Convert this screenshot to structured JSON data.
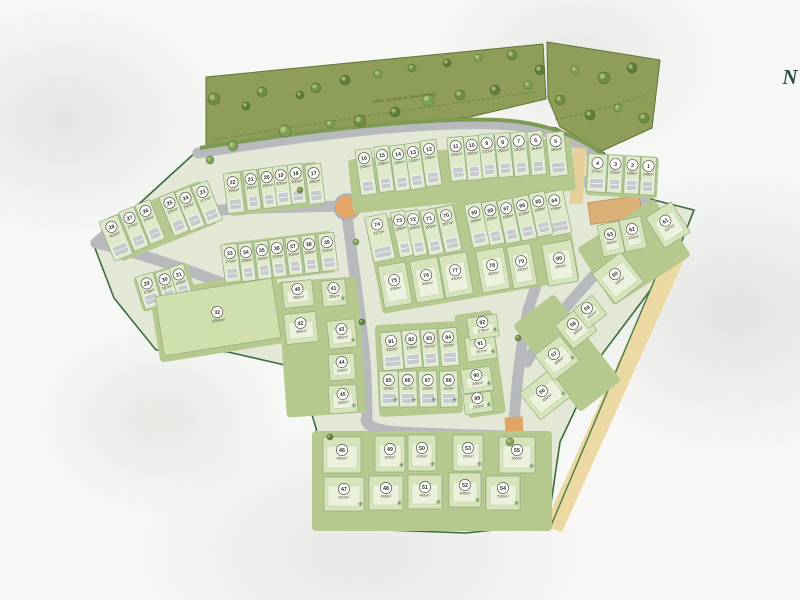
{
  "map": {
    "north_label": "N",
    "open_space_label": "AREA OF PUBLIC OPEN SPACE",
    "roundabout_color": "#e2a667",
    "road_color": "#b7babc",
    "boundary_color": "#3c6b3c",
    "open_space_color": "#8e9e58",
    "plots": [
      {
        "num": "1",
        "area": "248m²",
        "x": 648,
        "y": 176,
        "w": 15,
        "h": 38,
        "rot": 3,
        "kind": "row",
        "tree": 0
      },
      {
        "num": "2",
        "area": "188m²",
        "x": 632,
        "y": 175,
        "w": 15,
        "h": 38,
        "rot": 3,
        "kind": "row",
        "tree": 0
      },
      {
        "num": "3",
        "area": "205m²",
        "x": 615,
        "y": 174,
        "w": 15,
        "h": 38,
        "rot": 3,
        "kind": "row",
        "tree": 0
      },
      {
        "num": "4",
        "area": "370m²",
        "x": 597,
        "y": 173,
        "w": 19,
        "h": 38,
        "rot": 3,
        "kind": "row",
        "tree": 0
      },
      {
        "num": "5",
        "area": "265m²",
        "x": 557,
        "y": 154,
        "w": 18,
        "h": 44,
        "rot": -6,
        "kind": "row",
        "tree": 0
      },
      {
        "num": "6",
        "area": "184m²",
        "x": 537,
        "y": 153,
        "w": 15,
        "h": 44,
        "rot": -6,
        "kind": "row",
        "tree": 0
      },
      {
        "num": "7",
        "area": "190m²",
        "x": 520,
        "y": 154,
        "w": 15,
        "h": 44,
        "rot": -6,
        "kind": "row",
        "tree": 0
      },
      {
        "num": "8",
        "area": "255m²",
        "x": 504,
        "y": 155,
        "w": 15,
        "h": 44,
        "rot": -6,
        "kind": "row",
        "tree": 0
      },
      {
        "num": "9",
        "area": "210m²",
        "x": 488,
        "y": 156,
        "w": 15,
        "h": 44,
        "rot": -6,
        "kind": "row",
        "tree": 0
      },
      {
        "num": "10",
        "area": "200m²",
        "x": 473,
        "y": 158,
        "w": 15,
        "h": 44,
        "rot": -6,
        "kind": "row",
        "tree": 0
      },
      {
        "num": "11",
        "area": "245m²",
        "x": 457,
        "y": 159,
        "w": 16,
        "h": 44,
        "rot": -6,
        "kind": "row",
        "tree": 0
      },
      {
        "num": "12",
        "area": "245m²",
        "x": 431,
        "y": 163,
        "w": 16,
        "h": 46,
        "rot": -8,
        "kind": "row",
        "tree": 0
      },
      {
        "num": "13",
        "area": "210m²",
        "x": 415,
        "y": 166,
        "w": 15,
        "h": 46,
        "rot": -8,
        "kind": "row",
        "tree": 0
      },
      {
        "num": "14",
        "area": "200m²",
        "x": 400,
        "y": 168,
        "w": 15,
        "h": 46,
        "rot": -8,
        "kind": "row",
        "tree": 0
      },
      {
        "num": "15",
        "area": "200m²",
        "x": 384,
        "y": 169,
        "w": 15,
        "h": 46,
        "rot": -8,
        "kind": "row",
        "tree": 0
      },
      {
        "num": "16",
        "area": "200m²",
        "x": 366,
        "y": 172,
        "w": 16,
        "h": 46,
        "rot": -8,
        "kind": "row",
        "tree": 0
      },
      {
        "num": "17",
        "area": "185m²",
        "x": 315,
        "y": 184,
        "w": 16,
        "h": 40,
        "rot": -7,
        "kind": "row",
        "tree": 0
      },
      {
        "num": "18",
        "area": "200m²",
        "x": 297,
        "y": 184,
        "w": 15,
        "h": 40,
        "rot": -7,
        "kind": "row",
        "tree": 0
      },
      {
        "num": "19",
        "area": "200m²",
        "x": 282,
        "y": 186,
        "w": 15,
        "h": 40,
        "rot": -7,
        "kind": "row",
        "tree": 0
      },
      {
        "num": "20",
        "area": "185m²",
        "x": 268,
        "y": 188,
        "w": 14,
        "h": 40,
        "rot": -7,
        "kind": "row",
        "tree": 0
      },
      {
        "num": "21",
        "area": "182m²",
        "x": 252,
        "y": 190,
        "w": 14,
        "h": 40,
        "rot": -7,
        "kind": "row",
        "tree": 0
      },
      {
        "num": "22",
        "area": "226m²",
        "x": 234,
        "y": 193,
        "w": 17,
        "h": 40,
        "rot": -7,
        "kind": "row",
        "tree": 0
      },
      {
        "num": "23",
        "area": "277m²",
        "x": 207,
        "y": 203,
        "w": 17,
        "h": 42,
        "rot": -22,
        "kind": "row",
        "tree": 0
      },
      {
        "num": "24",
        "area": "260m²",
        "x": 190,
        "y": 209,
        "w": 16,
        "h": 42,
        "rot": -22,
        "kind": "row",
        "tree": 0
      },
      {
        "num": "25",
        "area": "235m²",
        "x": 174,
        "y": 214,
        "w": 16,
        "h": 42,
        "rot": -22,
        "kind": "row",
        "tree": 0
      },
      {
        "num": "26",
        "area": "245m²",
        "x": 150,
        "y": 222,
        "w": 16,
        "h": 42,
        "rot": -22,
        "kind": "row",
        "tree": 0
      },
      {
        "num": "27",
        "area": "270m²",
        "x": 134,
        "y": 229,
        "w": 16,
        "h": 42,
        "rot": -22,
        "kind": "row",
        "tree": 0
      },
      {
        "num": "28",
        "area": "403m²",
        "x": 116,
        "y": 238,
        "w": 20,
        "h": 42,
        "rot": -22,
        "kind": "row",
        "tree": 0
      },
      {
        "num": "29",
        "area": "278m²",
        "x": 149,
        "y": 291,
        "w": 18,
        "h": 34,
        "rot": -17,
        "kind": "row",
        "tree": 0
      },
      {
        "num": "30",
        "area": "187m²",
        "x": 167,
        "y": 287,
        "w": 15,
        "h": 34,
        "rot": -17,
        "kind": "row",
        "tree": 0
      },
      {
        "num": "31",
        "area": "205m²",
        "x": 181,
        "y": 282,
        "w": 15,
        "h": 34,
        "rot": -17,
        "kind": "row",
        "tree": 0
      },
      {
        "num": "32",
        "area": "2056m²",
        "x": 218,
        "y": 317,
        "w": 118,
        "h": 60,
        "rot": -9,
        "kind": "field",
        "tree": 0
      },
      {
        "num": "33",
        "area": "275m²",
        "x": 231,
        "y": 263,
        "w": 16,
        "h": 38,
        "rot": -7,
        "kind": "row",
        "tree": 0
      },
      {
        "num": "34",
        "area": "208m²",
        "x": 247,
        "y": 262,
        "w": 14,
        "h": 38,
        "rot": -7,
        "kind": "row",
        "tree": 0
      },
      {
        "num": "35",
        "area": "183m²",
        "x": 263,
        "y": 260,
        "w": 14,
        "h": 38,
        "rot": -7,
        "kind": "row",
        "tree": 0
      },
      {
        "num": "36",
        "area": "192m²",
        "x": 278,
        "y": 258,
        "w": 14,
        "h": 38,
        "rot": -7,
        "kind": "row",
        "tree": 0
      },
      {
        "num": "37",
        "area": "200m²",
        "x": 294,
        "y": 256,
        "w": 14,
        "h": 38,
        "rot": -7,
        "kind": "row",
        "tree": 0
      },
      {
        "num": "38",
        "area": "208m²",
        "x": 310,
        "y": 254,
        "w": 14,
        "h": 38,
        "rot": -7,
        "kind": "row",
        "tree": 0
      },
      {
        "num": "39",
        "area": "222m²",
        "x": 328,
        "y": 252,
        "w": 16,
        "h": 38,
        "rot": -7,
        "kind": "row",
        "tree": 0
      },
      {
        "num": "40",
        "area": "350m²",
        "x": 298,
        "y": 294,
        "w": 30,
        "h": 26,
        "rot": -6,
        "kind": "sq",
        "tree": 0
      },
      {
        "num": "41",
        "area": "205m²",
        "x": 334,
        "y": 293,
        "w": 24,
        "h": 26,
        "rot": -6,
        "kind": "sq",
        "tree": 1
      },
      {
        "num": "42",
        "area": "465m²",
        "x": 301,
        "y": 328,
        "w": 32,
        "h": 30,
        "rot": -6,
        "kind": "sq",
        "tree": 0
      },
      {
        "num": "43",
        "area": "352m²",
        "x": 342,
        "y": 334,
        "w": 28,
        "h": 28,
        "rot": -6,
        "kind": "sq",
        "tree": 1
      },
      {
        "num": "44",
        "area": "243m²",
        "x": 342,
        "y": 367,
        "w": 26,
        "h": 26,
        "rot": -4,
        "kind": "sq",
        "tree": 0
      },
      {
        "num": "45",
        "area": "325m²",
        "x": 343,
        "y": 399,
        "w": 28,
        "h": 28,
        "rot": -4,
        "kind": "sq",
        "tree": 1
      },
      {
        "num": "46",
        "area": "480m²",
        "x": 342,
        "y": 455,
        "w": 38,
        "h": 36,
        "rot": 0,
        "kind": "sq",
        "tree": 0
      },
      {
        "num": "47",
        "area": "510m²",
        "x": 344,
        "y": 494,
        "w": 40,
        "h": 34,
        "rot": 0,
        "kind": "sq",
        "tree": 1
      },
      {
        "num": "48",
        "area": "460m²",
        "x": 386,
        "y": 493,
        "w": 34,
        "h": 34,
        "rot": 0,
        "kind": "sq",
        "tree": 1
      },
      {
        "num": "49",
        "area": "325m²",
        "x": 390,
        "y": 454,
        "w": 30,
        "h": 36,
        "rot": 0,
        "kind": "sq",
        "tree": 1
      },
      {
        "num": "50",
        "area": "420m²",
        "x": 422,
        "y": 453,
        "w": 28,
        "h": 36,
        "rot": 0,
        "kind": "sq",
        "tree": 1
      },
      {
        "num": "51",
        "area": "465m²",
        "x": 425,
        "y": 492,
        "w": 34,
        "h": 34,
        "rot": 0,
        "kind": "sq",
        "tree": 1
      },
      {
        "num": "52",
        "area": "445m²",
        "x": 465,
        "y": 490,
        "w": 32,
        "h": 34,
        "rot": 0,
        "kind": "sq",
        "tree": 1
      },
      {
        "num": "53",
        "area": "320m²",
        "x": 468,
        "y": 453,
        "w": 30,
        "h": 36,
        "rot": 0,
        "kind": "sq",
        "tree": 1
      },
      {
        "num": "54",
        "area": "530m²",
        "x": 503,
        "y": 493,
        "w": 34,
        "h": 34,
        "rot": 0,
        "kind": "sq",
        "tree": 1
      },
      {
        "num": "55",
        "area": "500m²",
        "x": 517,
        "y": 455,
        "w": 36,
        "h": 36,
        "rot": 0,
        "kind": "sq",
        "tree": 1
      },
      {
        "num": "56",
        "area": "450m²",
        "x": 545,
        "y": 395,
        "w": 38,
        "h": 34,
        "rot": -38,
        "kind": "sq",
        "tree": 1
      },
      {
        "num": "57",
        "area": "408m²",
        "x": 557,
        "y": 358,
        "w": 32,
        "h": 32,
        "rot": -38,
        "kind": "sq",
        "tree": 1
      },
      {
        "num": "58",
        "area": "380m²",
        "x": 576,
        "y": 328,
        "w": 30,
        "h": 30,
        "rot": -38,
        "kind": "sq",
        "tree": 0
      },
      {
        "num": "59",
        "area": "303m²",
        "x": 590,
        "y": 312,
        "w": 24,
        "h": 24,
        "rot": -38,
        "kind": "sq",
        "tree": 0
      },
      {
        "num": "60",
        "area": "600m²",
        "x": 618,
        "y": 278,
        "w": 36,
        "h": 38,
        "rot": -38,
        "kind": "sq",
        "tree": 0
      },
      {
        "num": "61",
        "area": "537m²",
        "x": 668,
        "y": 225,
        "w": 30,
        "h": 36,
        "rot": -32,
        "kind": "sq",
        "tree": 0
      },
      {
        "num": "62",
        "area": "250m²",
        "x": 633,
        "y": 234,
        "w": 22,
        "h": 32,
        "rot": -12,
        "kind": "sq",
        "tree": 0
      },
      {
        "num": "63",
        "area": "360m²",
        "x": 611,
        "y": 239,
        "w": 22,
        "h": 32,
        "rot": -12,
        "kind": "sq",
        "tree": 0
      },
      {
        "num": "64",
        "area": "759m²",
        "x": 557,
        "y": 213,
        "w": 21,
        "h": 44,
        "rot": -12,
        "kind": "row",
        "tree": 0
      },
      {
        "num": "65",
        "area": "200m²",
        "x": 541,
        "y": 214,
        "w": 16,
        "h": 44,
        "rot": -12,
        "kind": "row",
        "tree": 0
      },
      {
        "num": "66",
        "area": "210m²",
        "x": 525,
        "y": 218,
        "w": 16,
        "h": 44,
        "rot": -12,
        "kind": "row",
        "tree": 0
      },
      {
        "num": "67",
        "area": "208m²",
        "x": 509,
        "y": 221,
        "w": 15,
        "h": 44,
        "rot": -12,
        "kind": "row",
        "tree": 0
      },
      {
        "num": "68",
        "area": "259m²",
        "x": 493,
        "y": 223,
        "w": 15,
        "h": 44,
        "rot": -12,
        "kind": "row",
        "tree": 0
      },
      {
        "num": "69",
        "area": "265m²",
        "x": 477,
        "y": 225,
        "w": 17,
        "h": 44,
        "rot": -12,
        "kind": "row",
        "tree": 0
      },
      {
        "num": "70",
        "area": "287m²",
        "x": 449,
        "y": 229,
        "w": 17,
        "h": 46,
        "rot": -12,
        "kind": "row",
        "tree": 0
      },
      {
        "num": "71",
        "area": "200m²",
        "x": 432,
        "y": 232,
        "w": 15,
        "h": 46,
        "rot": -12,
        "kind": "row",
        "tree": 0
      },
      {
        "num": "72",
        "area": "208m²",
        "x": 416,
        "y": 233,
        "w": 14,
        "h": 46,
        "rot": -12,
        "kind": "row",
        "tree": 0
      },
      {
        "num": "73",
        "area": "198m²",
        "x": 402,
        "y": 234,
        "w": 14,
        "h": 46,
        "rot": -12,
        "kind": "row",
        "tree": 0
      },
      {
        "num": "74",
        "area": "417m²",
        "x": 380,
        "y": 238,
        "w": 22,
        "h": 46,
        "rot": -12,
        "kind": "row",
        "tree": 0
      },
      {
        "num": "75",
        "area": "408m²",
        "x": 395,
        "y": 285,
        "w": 28,
        "h": 42,
        "rot": -10,
        "kind": "sq",
        "tree": 0
      },
      {
        "num": "76",
        "area": "406m²",
        "x": 427,
        "y": 280,
        "w": 28,
        "h": 42,
        "rot": -10,
        "kind": "sq",
        "tree": 0
      },
      {
        "num": "77",
        "area": "430m²",
        "x": 456,
        "y": 275,
        "w": 28,
        "h": 42,
        "rot": -10,
        "kind": "sq",
        "tree": 0
      },
      {
        "num": "78",
        "area": "400m²",
        "x": 493,
        "y": 270,
        "w": 28,
        "h": 42,
        "rot": -10,
        "kind": "sq",
        "tree": 0
      },
      {
        "num": "79",
        "area": "420m²",
        "x": 522,
        "y": 266,
        "w": 24,
        "h": 42,
        "rot": -10,
        "kind": "sq",
        "tree": 0
      },
      {
        "num": "80",
        "area": "450m²",
        "x": 560,
        "y": 263,
        "w": 30,
        "h": 42,
        "rot": -10,
        "kind": "sq",
        "tree": 0
      },
      {
        "num": "81",
        "area": "522m²",
        "x": 392,
        "y": 351,
        "w": 21,
        "h": 38,
        "rot": -5,
        "kind": "row",
        "tree": 0
      },
      {
        "num": "82",
        "area": "236m²",
        "x": 412,
        "y": 349,
        "w": 18,
        "h": 38,
        "rot": -5,
        "kind": "row",
        "tree": 0
      },
      {
        "num": "83",
        "area": "337m²",
        "x": 430,
        "y": 348,
        "w": 16,
        "h": 38,
        "rot": -5,
        "kind": "row",
        "tree": 0
      },
      {
        "num": "84",
        "area": "294m²",
        "x": 449,
        "y": 347,
        "w": 18,
        "h": 38,
        "rot": -5,
        "kind": "row",
        "tree": 0
      },
      {
        "num": "85",
        "area": "324m²",
        "x": 389,
        "y": 389,
        "w": 19,
        "h": 36,
        "rot": -2,
        "kind": "row",
        "tree": 1
      },
      {
        "num": "86",
        "area": "227m²",
        "x": 408,
        "y": 389,
        "w": 18,
        "h": 36,
        "rot": -2,
        "kind": "row",
        "tree": 1
      },
      {
        "num": "87",
        "area": "250m²",
        "x": 428,
        "y": 389,
        "w": 18,
        "h": 36,
        "rot": -2,
        "kind": "row",
        "tree": 1
      },
      {
        "num": "88",
        "area": "263m²",
        "x": 449,
        "y": 389,
        "w": 18,
        "h": 36,
        "rot": -2,
        "kind": "row",
        "tree": 1
      },
      {
        "num": "89",
        "area": "243m²",
        "x": 478,
        "y": 403,
        "w": 28,
        "h": 20,
        "rot": -8,
        "kind": "sq",
        "tree": 1
      },
      {
        "num": "90",
        "area": "306m²",
        "x": 477,
        "y": 380,
        "w": 30,
        "h": 24,
        "rot": -8,
        "kind": "sq",
        "tree": 1
      },
      {
        "num": "91",
        "area": "257m²",
        "x": 481,
        "y": 348,
        "w": 30,
        "h": 24,
        "rot": -8,
        "kind": "sq",
        "tree": 1
      },
      {
        "num": "92",
        "area": "278m²",
        "x": 483,
        "y": 327,
        "w": 30,
        "h": 22,
        "rot": -8,
        "kind": "sq",
        "tree": 1
      }
    ]
  }
}
